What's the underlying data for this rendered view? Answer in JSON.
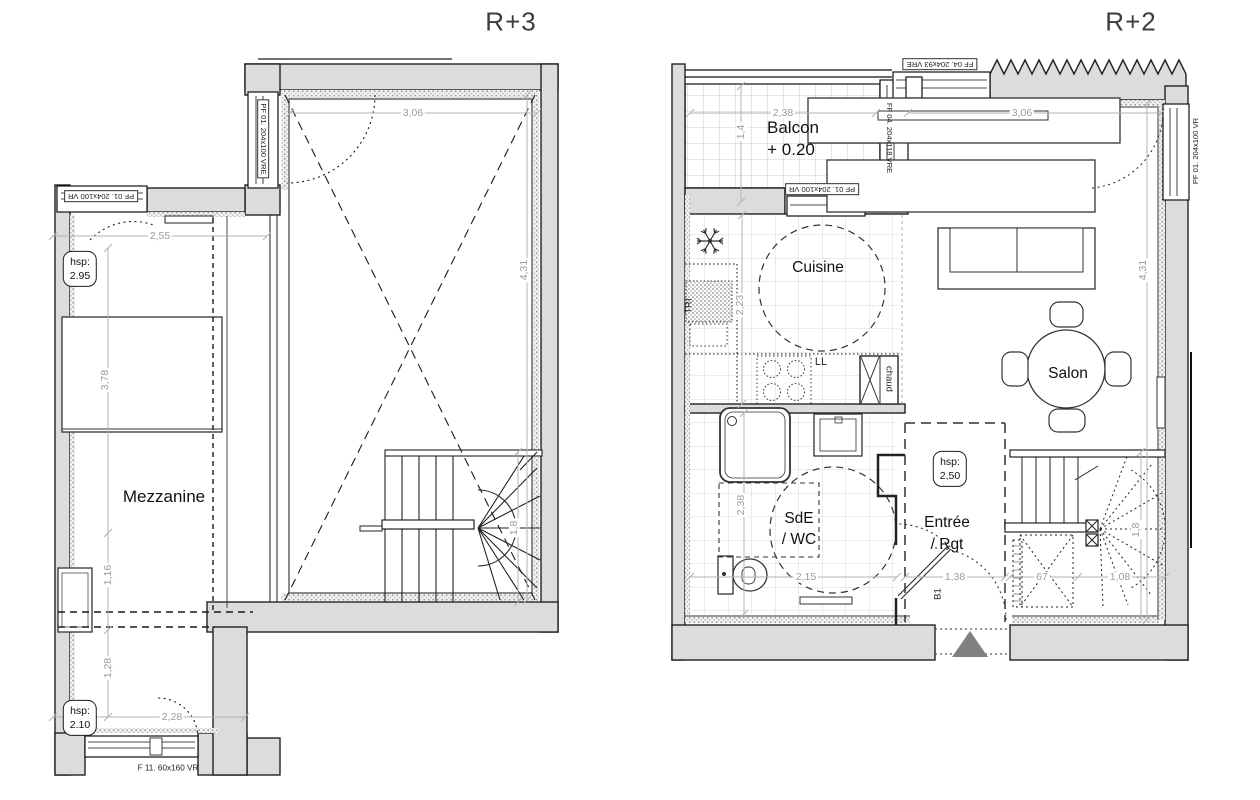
{
  "colors": {
    "wall_fill": "#dcdcdc",
    "line": "#222222",
    "dim": "#9c9c9c",
    "triangle": "#808080"
  },
  "icons": {
    "fridge": "snowflake-icon",
    "entrance": "entrance-triangle-icon"
  },
  "plans": [
    {
      "title": "R+3",
      "rooms": {
        "mezzanine": "Mezzanine"
      },
      "height_boxes": [
        {
          "label": "hsp:",
          "value": "2.95"
        },
        {
          "label": "hsp:",
          "value": "2.10"
        }
      ],
      "windows": {
        "left": "PF 01. 204x100 VR",
        "top_vertical": "PF 01. 204x100 VRE",
        "bottom": "F 11. 60x160 VR"
      },
      "dims": {
        "top_width": "3,06",
        "mezz_width": "2,55",
        "room_height": "4,31",
        "bed_length": "3,78",
        "d116": "1,16",
        "d128": "1,28",
        "bottom_width": "2,28",
        "stair": "1,8"
      }
    },
    {
      "title": "R+2",
      "rooms": {
        "balcon": "Balcon",
        "balcon_level": "+ 0.20",
        "cuisine": "Cuisine",
        "salon": "Salon",
        "sde_line1": "SdE",
        "sde_line2": "/ WC",
        "entree_line1": "Entrée",
        "entree_line2": "/ Rgt"
      },
      "annotations": {
        "tri": "TRI",
        "ll": "LL",
        "chaud": "chaud",
        "b1": "B1"
      },
      "height_boxes": [
        {
          "label": "hsp:",
          "value": "2,50"
        }
      ],
      "windows": {
        "top": "FF 04. 204x93 VRE",
        "balcony_right": "FF 04. 204x118 VRE",
        "balcony_bottom": "PF 01. 204x100 VR",
        "right": "PF 01. 204x100 VR"
      },
      "dims": {
        "balcon_width": "2,38",
        "balcon_depth": "1,4",
        "top_width": "3,06",
        "room_height": "4,31",
        "kitchen_depth": "2,23",
        "sde_height": "2,38",
        "sde_width": "2,15",
        "entree_width": "1,38",
        "stair_w1": "67",
        "stair_w2": "1,08",
        "stair": "1,8"
      }
    }
  ]
}
